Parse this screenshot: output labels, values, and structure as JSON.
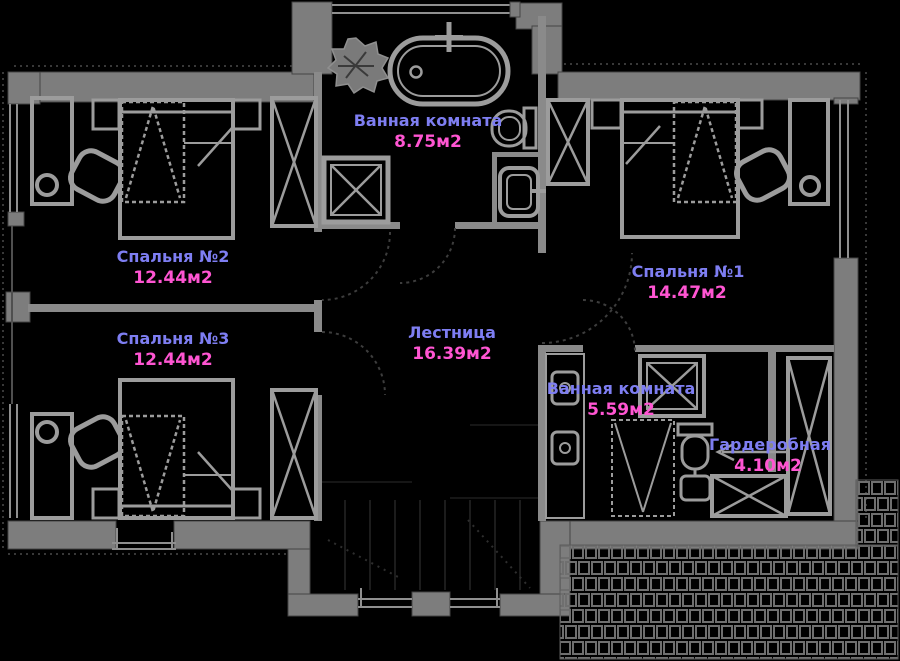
{
  "plan": {
    "background_color": "#000000",
    "wall_color": "#7d7d7d",
    "furniture_color": "#9c9c9c",
    "room_name_color": "#7e7ef2",
    "room_area_color": "#ff55d2",
    "area_unit": "м2",
    "rooms": [
      {
        "id": "bathroom-main",
        "name": "Ванная комната",
        "area": "8.75м2"
      },
      {
        "id": "bedroom-2",
        "name": "Спальня №2",
        "area": "12.44м2"
      },
      {
        "id": "bedroom-3",
        "name": "Спальня №3",
        "area": "12.44м2"
      },
      {
        "id": "bedroom-1",
        "name": "Спальня №1",
        "area": "14.47м2"
      },
      {
        "id": "staircase",
        "name": "Лестница",
        "area": "16.39м2"
      },
      {
        "id": "bathroom-2",
        "name": "Ванная комната",
        "area": "5.59м2"
      },
      {
        "id": "wardrobe-room",
        "name": "Гардеробная",
        "area": "4.10м2"
      }
    ]
  }
}
